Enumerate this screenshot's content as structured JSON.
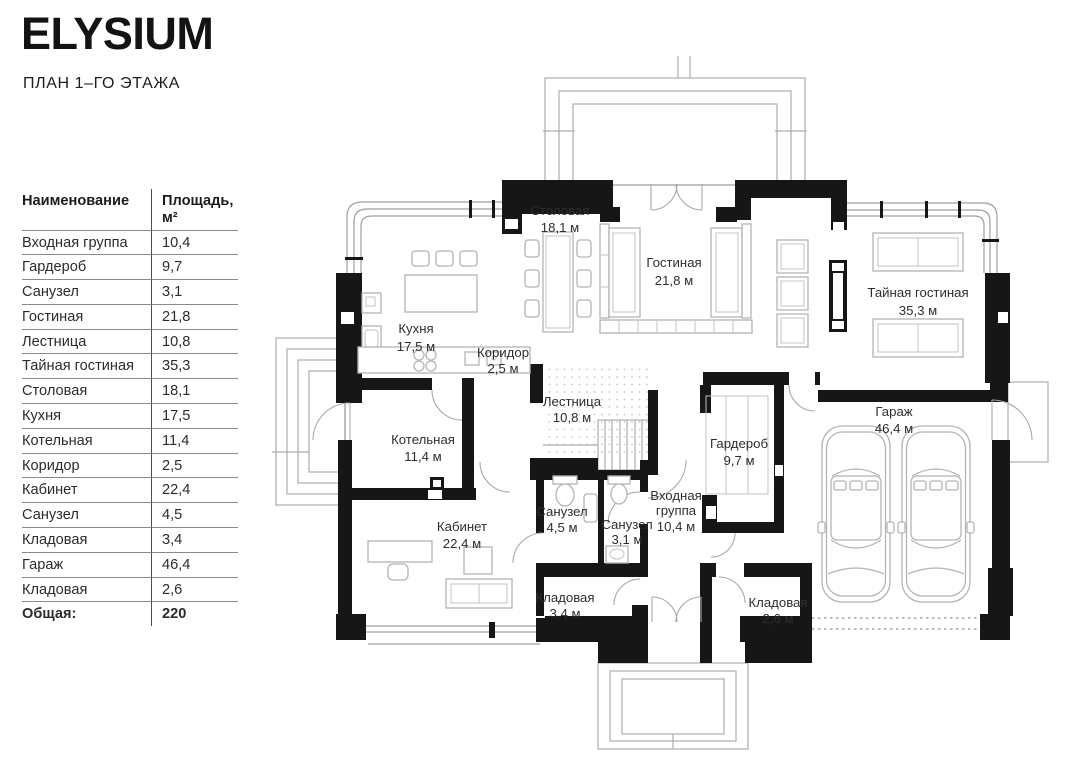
{
  "header": {
    "title": "ELYSIUM",
    "subtitle": "ПЛАН 1–ГО ЭТАЖА"
  },
  "legend_table": {
    "col_name": "Наименование",
    "col_area": "Площадь, м²",
    "rows": [
      {
        "name": "Входная группа",
        "area": "10,4"
      },
      {
        "name": "Гардероб",
        "area": "9,7"
      },
      {
        "name": "Санузел",
        "area": "3,1"
      },
      {
        "name": "Гостиная",
        "area": "21,8"
      },
      {
        "name": "Лестница",
        "area": "10,8"
      },
      {
        "name": "Тайная гостиная",
        "area": "35,3"
      },
      {
        "name": "Столовая",
        "area": "18,1"
      },
      {
        "name": "Кухня",
        "area": "17,5"
      },
      {
        "name": "Котельная",
        "area": "11,4"
      },
      {
        "name": "Коридор",
        "area": "2,5"
      },
      {
        "name": "Кабинет",
        "area": "22,4"
      },
      {
        "name": "Санузел",
        "area": "4,5"
      },
      {
        "name": "Кладовая",
        "area": "3,4"
      },
      {
        "name": "Гараж",
        "area": "46,4"
      },
      {
        "name": "Кладовая",
        "area": "2,6"
      }
    ],
    "total_label": "Общая:",
    "total_value": "220"
  },
  "plan": {
    "rooms": [
      {
        "name": "Столовая",
        "area": "18,1 м"
      },
      {
        "name": "Гостиная",
        "area": "21,8 м"
      },
      {
        "name": "Тайная гостиная",
        "area": "35,3 м"
      },
      {
        "name": "Кухня",
        "area": "17,5 м"
      },
      {
        "name": "Коридор",
        "area": "2,5 м"
      },
      {
        "name": "Лестница",
        "area": "10,8 м"
      },
      {
        "name": "Котельная",
        "area": "11,4 м"
      },
      {
        "name": "Гардероб",
        "area": "9,7 м"
      },
      {
        "name": "Гараж",
        "area": "46,4 м"
      },
      {
        "name": "Кабинет",
        "area": "22,4 м"
      },
      {
        "name": "Санузел",
        "area": "4,5 м"
      },
      {
        "name": "Санузел",
        "area": "3,1 м"
      },
      {
        "name": "Входная группа",
        "l1": "Входная",
        "l2": "группа",
        "area": "10,4 м"
      },
      {
        "name": "Кладовая",
        "area": "3,4 м"
      },
      {
        "name": "Кладовая",
        "area": "2,6 м"
      }
    ]
  },
  "colors": {
    "wall": "#161616",
    "furniture_line": "#b4b4b4",
    "text": "#2e2e2e",
    "table_divider": "#4f4f4f"
  }
}
